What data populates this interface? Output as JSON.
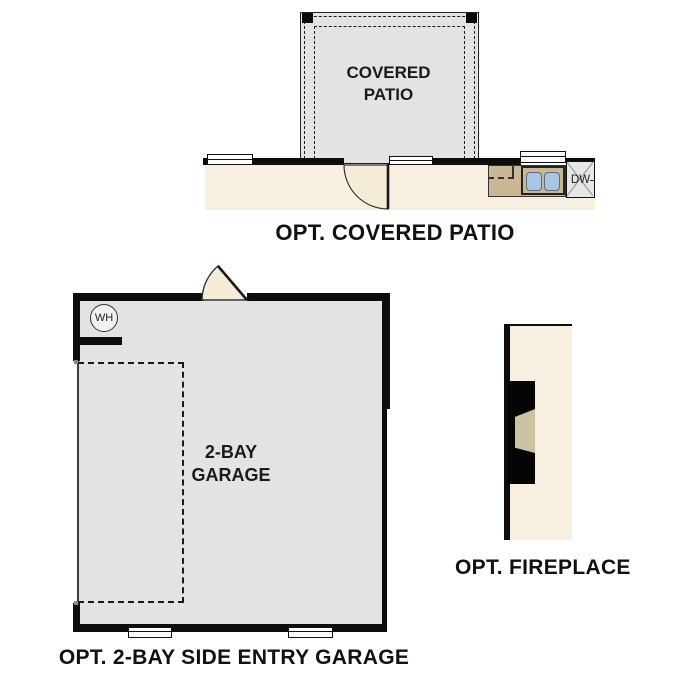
{
  "colors": {
    "floor-gray": "#e3e3e2",
    "interior-cream": "#f7efe0",
    "door-cream": "#f5ecd8",
    "counter-tan": "#c9b795",
    "sink-blue": "#abc6e5",
    "wall-black": "#0d0d0d",
    "insert-tan": "#cdc2a4"
  },
  "patio": {
    "room_label": "COVERED PATIO",
    "caption": "OPT. COVERED PATIO"
  },
  "kitchen": {
    "dishwasher_label": "DW"
  },
  "garage": {
    "room_label": "2-BAY GARAGE",
    "water_heater_label": "WH",
    "caption": "OPT. 2-BAY SIDE ENTRY GARAGE"
  },
  "fireplace": {
    "caption": "OPT. FIREPLACE"
  }
}
